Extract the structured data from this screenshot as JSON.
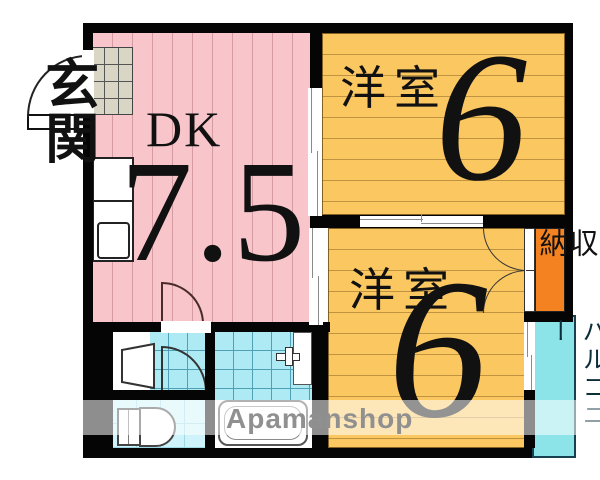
{
  "floorplan": {
    "entrance": {
      "label": "玄関"
    },
    "dk": {
      "label": "DK",
      "size": "7.5"
    },
    "room_top": {
      "label": "洋室",
      "size": "6"
    },
    "room_bottom": {
      "label": "洋室",
      "size": "6"
    },
    "closet": {
      "label": "収納"
    },
    "balcony": {
      "label": "バルコニー"
    },
    "watermark": {
      "label": "Apamanshop"
    },
    "colors": {
      "dk_fill": "#f7c5ca",
      "dk_stripe": "#d49ba3",
      "room_fill": "#fbc761",
      "room_stripe": "#bf9340",
      "closet_fill": "#f58220",
      "balcony_fill": "#8ce4e9",
      "bath_tile": "#aeeaf3",
      "toilet_tile": "#cff3fa",
      "shoe_cabinet": "#d9d6c5",
      "wall": "#050505",
      "watermark_text": "#909090"
    }
  }
}
